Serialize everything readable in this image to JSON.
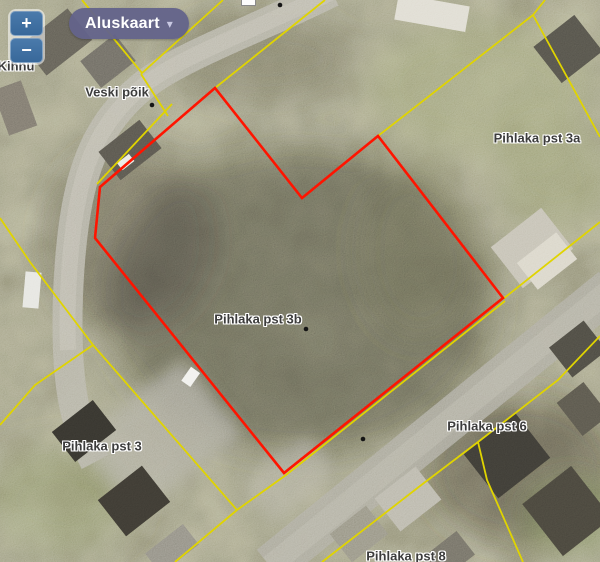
{
  "app": {
    "zoom_in": "+",
    "zoom_out": "−",
    "basemap_button": {
      "label": "Aluskaart",
      "caret": "▾"
    }
  },
  "map": {
    "street_labels": [
      {
        "text": "Veski põik",
        "x": 117,
        "y": 92
      },
      {
        "text": "Pihlaka pst 3a",
        "x": 537,
        "y": 138
      },
      {
        "text": "Pihlaka pst 3b",
        "x": 258,
        "y": 319
      },
      {
        "text": "Pihlaka pst 3",
        "x": 102,
        "y": 446
      },
      {
        "text": "Pihlaka pst 6",
        "x": 487,
        "y": 426
      },
      {
        "text": "Pihlaka pst 8",
        "x": 406,
        "y": 556
      },
      {
        "text": "Kihnu",
        "x": 16,
        "y": 66
      }
    ],
    "selected_parcel": {
      "name": "Pihlaka pst 3b",
      "points": "215,88 100,187 95,238 284,473 503,298 378,136 302,198"
    },
    "cadastral_lines": [
      "82,0 142,73",
      "223,0 141,74",
      "141,74 168,116",
      "325,0 215,88",
      "172,104 97,184",
      "545,0 533,15",
      "533,15 378,136",
      "533,15 600,137",
      "600,222 503,299",
      "505,301 286,475 237,510",
      "237,510 93,345",
      "237,510 175,562",
      "93,345 30,262 0,218",
      "93,345 35,385 0,425",
      "600,336 558,380 478,442",
      "478,442 420,486 322,562",
      "478,442 487,480 523,562"
    ],
    "point_markers": [
      {
        "x": 152,
        "y": 105
      },
      {
        "x": 280,
        "y": 5
      },
      {
        "x": 363,
        "y": 439
      },
      {
        "x": 306,
        "y": 329
      }
    ],
    "colors": {
      "selected_outline": "#ff1400",
      "cadastral_line": "#e0d400",
      "label_text": "#3c3c3c",
      "label_halo": "#ffffff"
    }
  }
}
